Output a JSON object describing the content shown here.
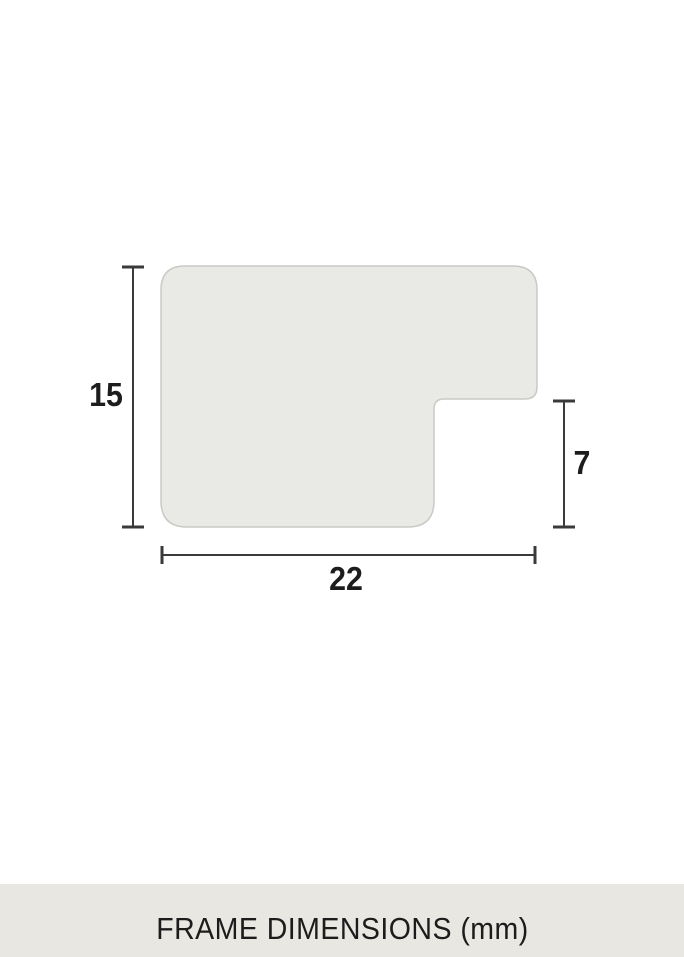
{
  "diagram": {
    "height_label": "15",
    "notch_height_label": "7",
    "width_label": "22",
    "shape_fill": "#e9e9e5",
    "shape_border": "#c9c9c6",
    "dimension_line_color": "#3a3a3a",
    "label_color": "#1d1d1d"
  },
  "caption": {
    "text": "FRAME DIMENSIONS (mm)",
    "background": "#e8e7e2",
    "text_color": "#1c1c1c"
  }
}
